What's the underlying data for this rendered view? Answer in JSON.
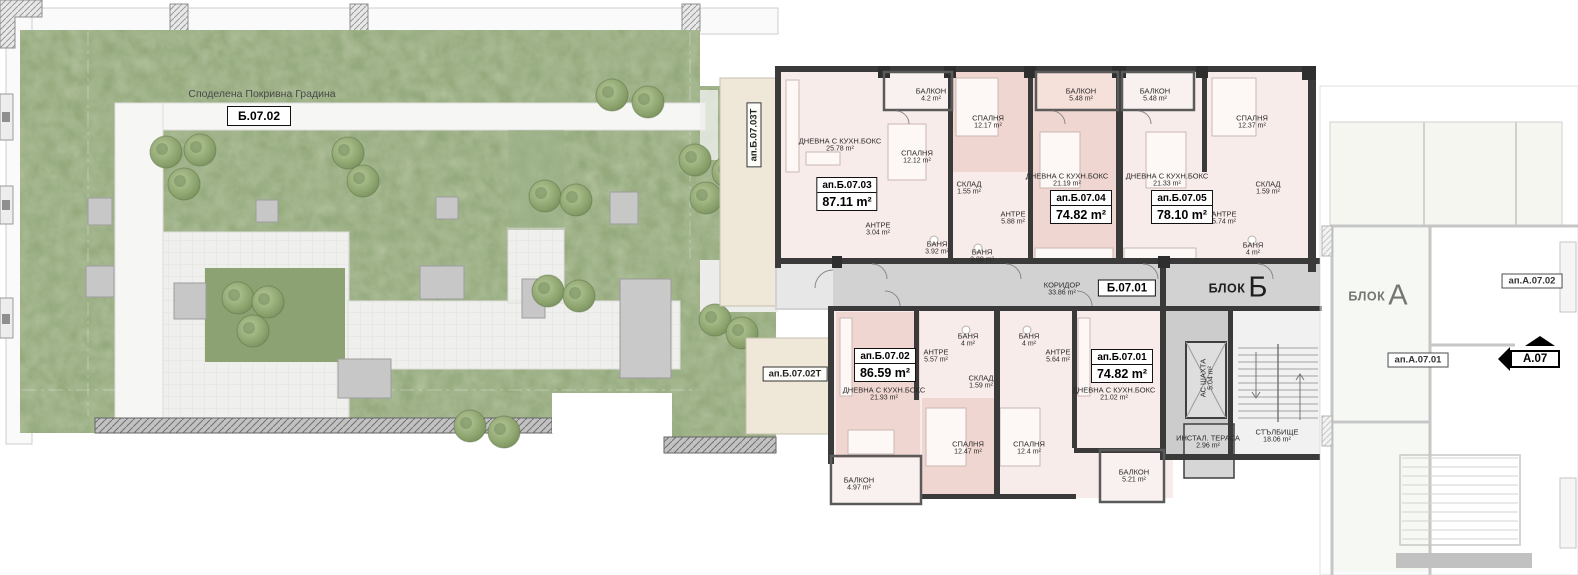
{
  "garden": {
    "title": "Споделена Покривна Градина",
    "zone_label": "Б.07.02"
  },
  "terraces": {
    "t1": "ап.Б.07.03Т",
    "t2": "ап.Б.07.02Т"
  },
  "block_b": {
    "label": "БЛОК",
    "letter": "Б",
    "corridor_zone": "Б.07.01",
    "apartments": [
      {
        "id": "ап.Б.07.03",
        "area": "87.11 m²"
      },
      {
        "id": "ап.Б.07.04",
        "area": "74.82 m²"
      },
      {
        "id": "ап.Б.07.05",
        "area": "78.10 m²"
      },
      {
        "id": "ап.Б.07.02",
        "area": "86.59 m²"
      },
      {
        "id": "ап.Б.07.01",
        "area": "74.82 m²"
      }
    ],
    "rooms": [
      {
        "name": "БАЛКОН",
        "area": "4.2 m²"
      },
      {
        "name": "СПАЛНЯ",
        "area": "12.12 m²"
      },
      {
        "name": "СПАЛНЯ",
        "area": "12.17 m²"
      },
      {
        "name": "ДНЕВНА С КУХН.БОКС",
        "area": "25.78 m²"
      },
      {
        "name": "СКЛАД",
        "area": "1.55 m²"
      },
      {
        "name": "АНТРЕ",
        "area": "3.04 m²"
      },
      {
        "name": "БАНЯ",
        "area": "3.92 m²"
      },
      {
        "name": "БАНЯ",
        "area": "3.88 m²"
      },
      {
        "name": "АНТРЕ",
        "area": "5.88 m²"
      },
      {
        "name": "БАЛКОН",
        "area": "5.48 m²"
      },
      {
        "name": "ДНЕВНА С КУХН.БОКС",
        "area": "21.19 m²"
      },
      {
        "name": "БАЛКОН",
        "area": "5.48 m²"
      },
      {
        "name": "ДНЕВНА С КУХН.БОКС",
        "area": "21.33 m²"
      },
      {
        "name": "СПАЛНЯ",
        "area": "12.37 m²"
      },
      {
        "name": "СКЛАД",
        "area": "1.59 m²"
      },
      {
        "name": "АНТРЕ",
        "area": "5.74 m²"
      },
      {
        "name": "БАНЯ",
        "area": "4 m²"
      },
      {
        "name": "КОРИДОР",
        "area": "33.86 m²"
      },
      {
        "name": "АНТРЕ",
        "area": "5.57 m²"
      },
      {
        "name": "БАНЯ",
        "area": "4 m²"
      },
      {
        "name": "БАНЯ",
        "area": "4 m²"
      },
      {
        "name": "АНТРЕ",
        "area": "5.64 m²"
      },
      {
        "name": "СКЛАД",
        "area": "1.59 m²"
      },
      {
        "name": "ДНЕВНА С КУХН.БОКС",
        "area": "21.93 m²"
      },
      {
        "name": "ДНЕВНА С КУХН.БОКС",
        "area": "21.02 m²"
      },
      {
        "name": "СПАЛНЯ",
        "area": "12.47 m²"
      },
      {
        "name": "СПАЛНЯ",
        "area": "12.4 m²"
      },
      {
        "name": "БАЛКОН",
        "area": "4.97 m²"
      },
      {
        "name": "БАЛКОН",
        "area": "5.21 m²"
      },
      {
        "name": "АС ШАХТА",
        "area": "5.04 m²"
      },
      {
        "name": "ИНСТАЛ. ТЕРАСА",
        "area": "2.96 m²"
      },
      {
        "name": "СТЪЛБИЩЕ",
        "area": "18.06 m²"
      }
    ]
  },
  "block_a": {
    "label": "БЛОК",
    "letter": "А",
    "apartments": [
      {
        "id": "ап.А.07.02"
      },
      {
        "id": "ап.А.07.01"
      }
    ],
    "marker": "А.07"
  },
  "colors": {
    "grass": "#8da273",
    "room_light": "#f8ecea",
    "room_rose": "#f0d6d0",
    "balcony": "#f9f1ef",
    "corridor": "#d2d2d2",
    "terrace": "#efe8d9",
    "wall": "#3a3a3a"
  }
}
